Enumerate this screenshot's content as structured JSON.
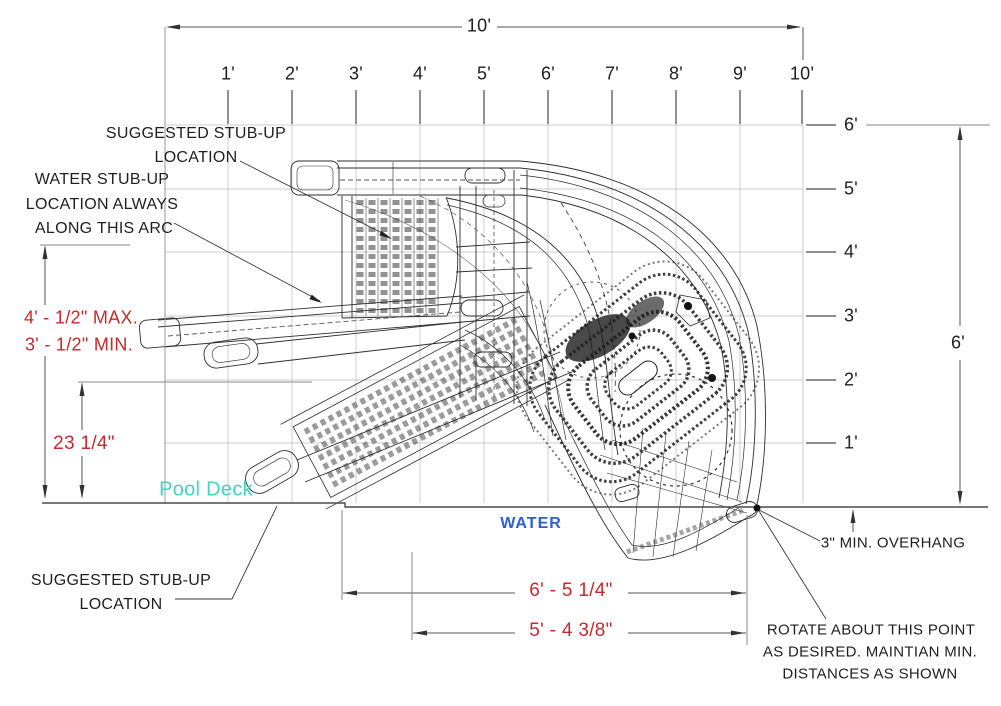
{
  "rulers": {
    "top": [
      "1'",
      "2'",
      "3'",
      "4'",
      "5'",
      "6'",
      "7'",
      "8'",
      "9'",
      "10'"
    ],
    "right": [
      "6'",
      "5'",
      "4'",
      "3'",
      "2'",
      "1'"
    ]
  },
  "dims": {
    "overall_width": "10'",
    "overall_height": "6'",
    "max_min": [
      "4' - 1/2\" MAX.",
      "3' - 1/2\" MIN."
    ],
    "stub_height": "23 1/4\"",
    "deck_to_end": "6' - 5 1/4\"",
    "deck_to_rail": "5' - 4 3/8\"",
    "overhang": "3\" MIN. OVERHANG"
  },
  "labels": {
    "suggested_top": [
      "SUGGESTED STUB-UP",
      "LOCATION"
    ],
    "water_stub": [
      "WATER STUB-UP",
      "LOCATION ALWAYS",
      "ALONG THIS ARC"
    ],
    "suggested_bottom": [
      "SUGGESTED STUB-UP",
      "LOCATION"
    ],
    "pool_deck": "Pool Deck",
    "water": "WATER",
    "rotate_note": [
      "ROTATE ABOUT THIS POINT",
      "AS DESIRED. MAINTIAN MIN.",
      "DISTANCES AS SHOWN"
    ]
  },
  "colors": {
    "dimension_red": "#c52a2e",
    "pool_deck_teal": "#3fd6c3",
    "water_blue": "#2d5fd3",
    "drawing_line": "#2e2e2e",
    "grid_gray": "#cccccc"
  }
}
